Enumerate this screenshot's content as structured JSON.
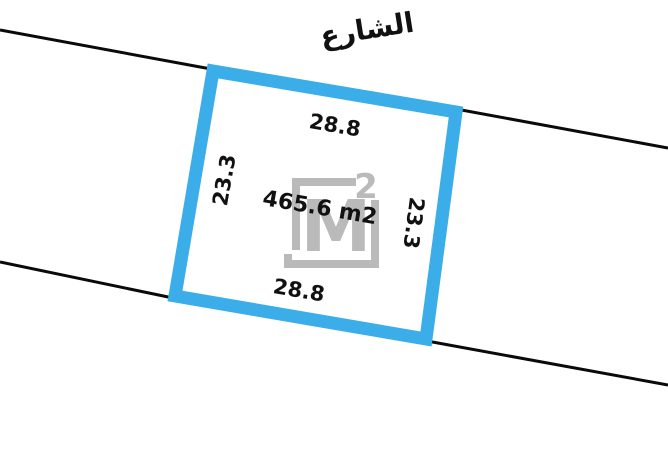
{
  "street": {
    "label": "الشارع"
  },
  "plot": {
    "area_label": "465.6 m2",
    "top_length": "28.8",
    "bottom_length": "28.8",
    "left_length": "23.3",
    "right_length": "23.3"
  },
  "watermark": {
    "letter": "M",
    "exponent": "2"
  },
  "colors": {
    "plot_border": "#3bade8",
    "plot_fill": "#ffffff",
    "street_line": "#0a0a0a",
    "text": "#111111",
    "watermark": "#bababa"
  }
}
